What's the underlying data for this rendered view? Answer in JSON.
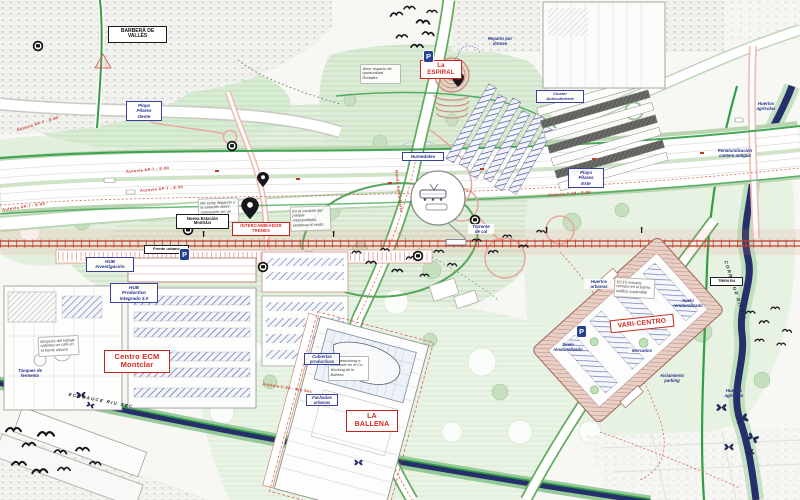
{
  "map_title": "Masterplan Montclar - Barberà del Vallès",
  "colors": {
    "rail_red": "#c43c30",
    "eco_green": "#2f9e44",
    "river_navy": "#25306b",
    "label_blue": "#27348b",
    "label_red": "#d6281e",
    "park_green": "#e2efdd",
    "urban_gray": "#dbdbd7"
  },
  "icons": {
    "parking_label": "P"
  },
  "labels": {
    "boxed_black": [
      {
        "text": "BARBERÀ DE\nVALLÈS"
      },
      {
        "text": "Nueva Estación\nMontclar"
      },
      {
        "text": "Frente urbano"
      },
      {
        "text": "TREN R4"
      }
    ],
    "boxed_red": [
      {
        "text": "La\nESPIRAL"
      },
      {
        "text": "INTERCAMBIADOR\nTRENES"
      },
      {
        "text": "Centro ECM\nMontclar"
      },
      {
        "text": "LA\nBALLENA"
      },
      {
        "text": "VARI·CENTRO"
      }
    ],
    "boxed_blue": [
      {
        "text": "Playa\nPilares\nOeste"
      },
      {
        "text": "Playa\nPilares\nEste"
      },
      {
        "text": "Humedales"
      },
      {
        "text": "Cluster\nAutosuficiente"
      },
      {
        "text": "HUB\nInvestigación"
      },
      {
        "text": "HUB\nProductivo\nIntegrado 3.0"
      }
    ],
    "blue_notes": [
      {
        "text": "Reparto por\ndrones"
      },
      {
        "text": "Cubiertas\nproductivas"
      },
      {
        "text": "Fachadas\nurbanas"
      },
      {
        "text": "Huertos\nurbanos"
      },
      {
        "text": "Mercados"
      },
      {
        "text": "Suelo\nrenaturalizado"
      },
      {
        "text": "Suelo\nrenaturalizado"
      },
      {
        "text": "Aislamiento\nparking"
      },
      {
        "text": "Renaturalización\ncantera antigua"
      },
      {
        "text": "Huertos\nagrícolas"
      },
      {
        "text": "Huertos\nagrícolas"
      },
      {
        "text": "Tanques de\nfermento"
      },
      {
        "text": "Torrente\nde cal"
      }
    ],
    "road_red": [
      {
        "text": "Autovía AP-7 - E-90"
      },
      {
        "text": "Autovía AP-7 - E-90"
      },
      {
        "text": "Autovía AP-7 - E-90"
      },
      {
        "text": "Autovía AP-7 - E-90"
      },
      {
        "text": "Autovía C-58 - E-90"
      },
      {
        "text": "Autovía C-58 - Riu Sec"
      },
      {
        "text": "Ronda Santa María"
      }
    ],
    "route_dark": [
      {
        "text": "ECOCAUCE RIU SEC"
      },
      {
        "text": "CORREDOR RIPOLL"
      }
    ],
    "annotations": [
      {
        "text": "Me estoy llegando a la estación sobre monopatín ¡en un click!"
      },
      {
        "text": "Área: espacio de oportunidad Rodalies"
      },
      {
        "text": "En el corazón del parque metropolitano, ventanas al verde"
      },
      {
        "text": "Después del trabajo saborea un café en el frente urbano"
      },
      {
        "text": "Haz networking e infórmate en el Co-Working de la Ballena"
      },
      {
        "text": "En 15 minutos compro en el barrio: edificio sostenible"
      }
    ]
  }
}
